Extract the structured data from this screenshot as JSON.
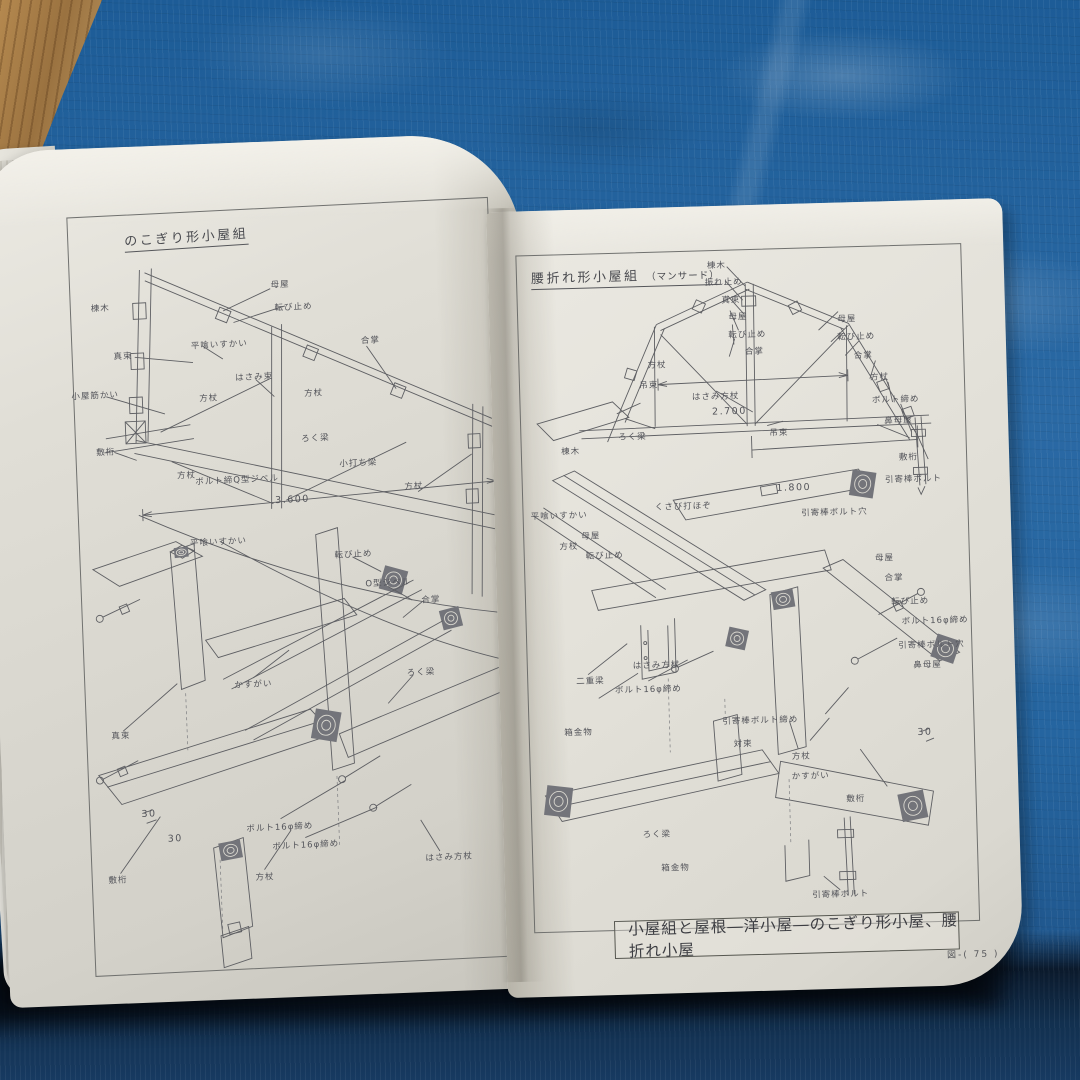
{
  "photo": {
    "description": "open book of Japanese timber roof-truss construction drawings lying on a blue tarp, wooden floor visible at top-left corner",
    "caption_box": "小屋組と屋根―洋小屋―のこぎり形小屋、腰折れ小屋",
    "page_footer": "図-( 75 )"
  },
  "colors": {
    "tarp": "#2565a0",
    "tarp_shadow": "#0c1c30",
    "wood_floor": "#a97e4e",
    "paper_left": "#dedcd4",
    "paper_right": "#e2e0d8",
    "ink": "#5e5f63"
  },
  "left_page": {
    "title": "のこぎり形小屋組",
    "labels": [
      {
        "t": "棟木",
        "x": 7,
        "y": 12
      },
      {
        "t": "母屋",
        "x": 50,
        "y": 10
      },
      {
        "t": "転び止め",
        "x": 53,
        "y": 13
      },
      {
        "t": "平喰いすかい",
        "x": 35,
        "y": 17.5
      },
      {
        "t": "合掌",
        "x": 71,
        "y": 18
      },
      {
        "t": "真束",
        "x": 12,
        "y": 18.5
      },
      {
        "t": "小屋筋かい",
        "x": 5,
        "y": 23.5
      },
      {
        "t": "はさみ束",
        "x": 43,
        "y": 22
      },
      {
        "t": "方杖",
        "x": 32,
        "y": 24.5
      },
      {
        "t": "方杖",
        "x": 57,
        "y": 24.5
      },
      {
        "t": "敷桁",
        "x": 7,
        "y": 31
      },
      {
        "t": "方杖",
        "x": 26,
        "y": 34.5
      },
      {
        "t": "ボルト締Q型ジベル",
        "x": 38,
        "y": 35.5
      },
      {
        "t": "ろく梁",
        "x": 57,
        "y": 30.5
      },
      {
        "t": "小打ち梁",
        "x": 67,
        "y": 34
      },
      {
        "t": "方杖",
        "x": 80,
        "y": 37.5
      },
      {
        "t": "3.600",
        "x": 51,
        "y": 38.5,
        "dim": true
      },
      {
        "t": "平喰いすかい",
        "x": 33,
        "y": 43.5
      },
      {
        "t": "転び止め",
        "x": 65,
        "y": 46
      },
      {
        "t": "O型ジベル",
        "x": 73,
        "y": 50
      },
      {
        "t": "合掌",
        "x": 83,
        "y": 52.5
      },
      {
        "t": "かすがい",
        "x": 40,
        "y": 62.5
      },
      {
        "t": "真束",
        "x": 8,
        "y": 68.5
      },
      {
        "t": "ろく梁",
        "x": 80,
        "y": 62
      },
      {
        "t": "30",
        "x": 14,
        "y": 79,
        "dim": true
      },
      {
        "t": "30",
        "x": 20,
        "y": 82.5,
        "dim": true
      },
      {
        "t": "ボルト16φ締め",
        "x": 45,
        "y": 81.5
      },
      {
        "t": "ボルト16φ締め",
        "x": 51,
        "y": 84
      },
      {
        "t": "はさみ方杖",
        "x": 85,
        "y": 86.5
      },
      {
        "t": "方杖",
        "x": 41,
        "y": 88
      },
      {
        "t": "敷桁",
        "x": 6,
        "y": 87.5
      }
    ]
  },
  "right_page": {
    "title": "腰折れ形小屋組",
    "title_note": "（マンサード）",
    "labels": [
      {
        "t": "棟木",
        "x": 45,
        "y": 2
      },
      {
        "t": "振れ止め",
        "x": 46.5,
        "y": 4.6
      },
      {
        "t": "真束",
        "x": 48,
        "y": 7.2
      },
      {
        "t": "母屋",
        "x": 49.5,
        "y": 9.8
      },
      {
        "t": "転び止め",
        "x": 51.5,
        "y": 12.4
      },
      {
        "t": "合掌",
        "x": 53,
        "y": 15
      },
      {
        "t": "母屋",
        "x": 74,
        "y": 10.5
      },
      {
        "t": "転び止め",
        "x": 76,
        "y": 13.2
      },
      {
        "t": "合掌",
        "x": 77.5,
        "y": 16
      },
      {
        "t": "方杖",
        "x": 81,
        "y": 19.3
      },
      {
        "t": "ボルト締め",
        "x": 84.5,
        "y": 22.6
      },
      {
        "t": "鼻母屋",
        "x": 85,
        "y": 25.8
      },
      {
        "t": "方杖",
        "x": 31,
        "y": 16.5
      },
      {
        "t": "吊束",
        "x": 29,
        "y": 19.5
      },
      {
        "t": "はさみ方杖",
        "x": 44,
        "y": 21.5
      },
      {
        "t": "2.700",
        "x": 47,
        "y": 23.8,
        "dim": true
      },
      {
        "t": "ろく梁",
        "x": 25,
        "y": 27
      },
      {
        "t": "吊束",
        "x": 58,
        "y": 27
      },
      {
        "t": "敷桁",
        "x": 87,
        "y": 31.2
      },
      {
        "t": "引寄棒ボルト",
        "x": 88,
        "y": 34.5
      },
      {
        "t": "1.800",
        "x": 61,
        "y": 35.3,
        "dim": true
      },
      {
        "t": "棟木",
        "x": 11,
        "y": 29
      },
      {
        "t": "平喰いすかい",
        "x": 8,
        "y": 38.5
      },
      {
        "t": "方杖",
        "x": 10,
        "y": 43
      },
      {
        "t": "くさび打ほぞ",
        "x": 36,
        "y": 37.5
      },
      {
        "t": "引寄棒ボルト穴",
        "x": 70,
        "y": 39
      },
      {
        "t": "母屋",
        "x": 15,
        "y": 41.5
      },
      {
        "t": "転び止め",
        "x": 18,
        "y": 44.5
      },
      {
        "t": "母屋",
        "x": 81,
        "y": 46
      },
      {
        "t": "合掌",
        "x": 83,
        "y": 49
      },
      {
        "t": "転び止め",
        "x": 86.5,
        "y": 52.5
      },
      {
        "t": "ボルト16φ締め",
        "x": 92,
        "y": 55.5
      },
      {
        "t": "引寄棒ボルト穴",
        "x": 91,
        "y": 59
      },
      {
        "t": "鼻母屋",
        "x": 90,
        "y": 62
      },
      {
        "t": "二重梁",
        "x": 14,
        "y": 63
      },
      {
        "t": "はさみ方杖",
        "x": 29,
        "y": 61
      },
      {
        "t": "ボルト16φ締め",
        "x": 27,
        "y": 64.5
      },
      {
        "t": "箱金物",
        "x": 11,
        "y": 70.5
      },
      {
        "t": "引寄棒ボルト締め",
        "x": 52,
        "y": 69.5
      },
      {
        "t": "対束",
        "x": 48,
        "y": 73
      },
      {
        "t": "方杖",
        "x": 61,
        "y": 75
      },
      {
        "t": "かすがい",
        "x": 63,
        "y": 78
      },
      {
        "t": "ろく梁",
        "x": 28,
        "y": 86
      },
      {
        "t": "箱金物",
        "x": 32,
        "y": 91
      },
      {
        "t": "敷桁",
        "x": 73,
        "y": 81.5
      },
      {
        "t": "引寄棒ボルト",
        "x": 69,
        "y": 95.5
      },
      {
        "t": "30",
        "x": 89,
        "y": 72,
        "dim": true
      }
    ]
  }
}
